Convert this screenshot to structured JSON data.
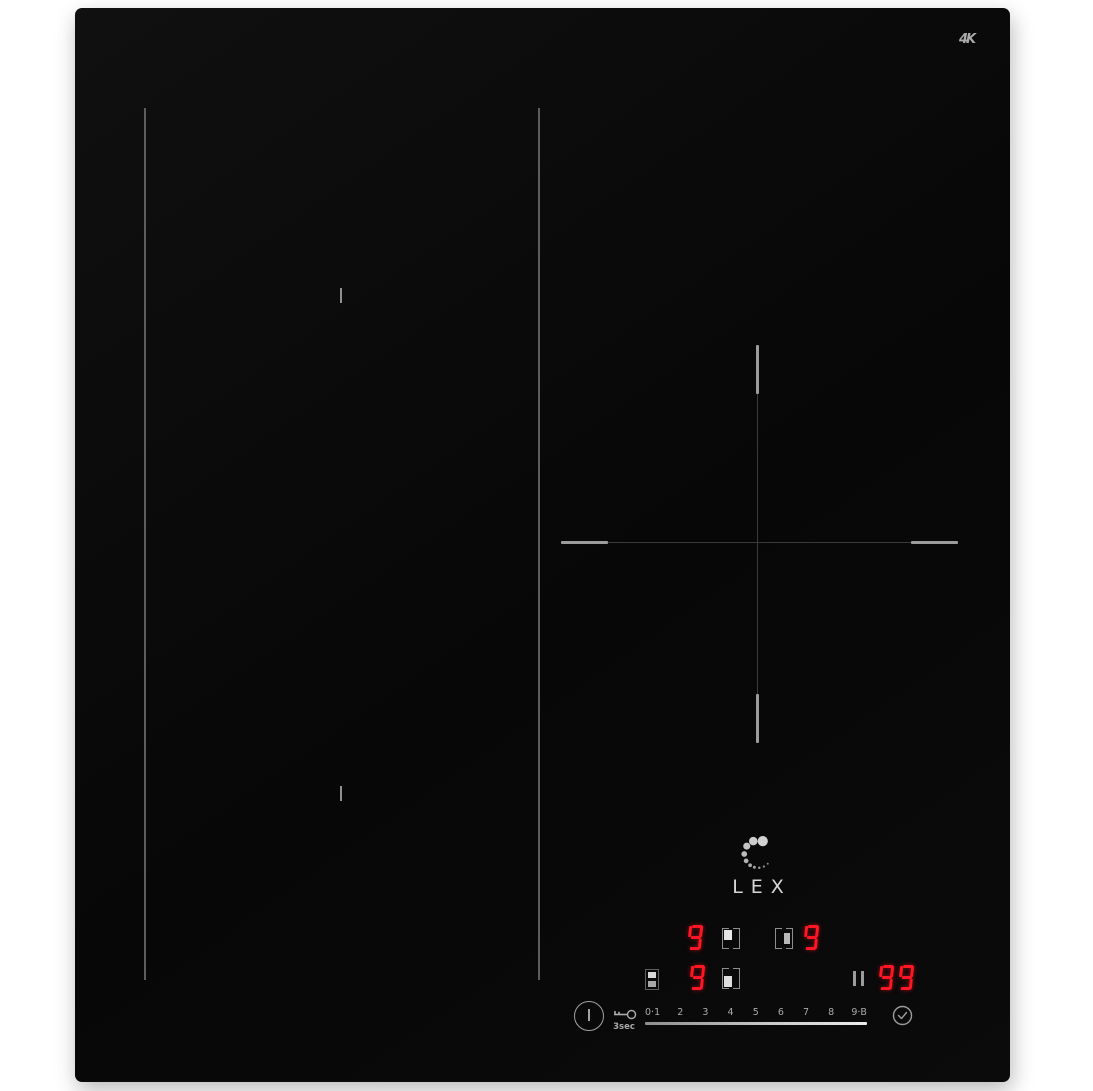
{
  "device": {
    "brand": "LEX",
    "corner_mark": "4K"
  },
  "colors": {
    "surface_black": "#0a0a0a",
    "led_red": "#ff1624",
    "marking_gray": "#9c9c9c",
    "label_gray": "#ababab"
  },
  "markings": {
    "left_flex_zone": "two vertical lines with center ticks",
    "right_zone": "cross hairline with bright end segments"
  },
  "control_panel": {
    "displays": {
      "zone_a_level": "9",
      "zone_b_level": "9",
      "zone_c_level": "9",
      "timer": "99"
    },
    "icons": {
      "zone_a": "zone-select-top-left",
      "zone_b": "zone-select-mid-right",
      "zone_c": "zone-select-bottom-left",
      "bridge": "bridge-zones",
      "pause": "pause-icon",
      "power": "power-icon",
      "lock": "key-icon",
      "timer": "clock-icon"
    },
    "lock_hold_label": "3sec",
    "power_levels": [
      "0·1",
      "2",
      "3",
      "4",
      "5",
      "6",
      "7",
      "8",
      "9·B"
    ]
  }
}
